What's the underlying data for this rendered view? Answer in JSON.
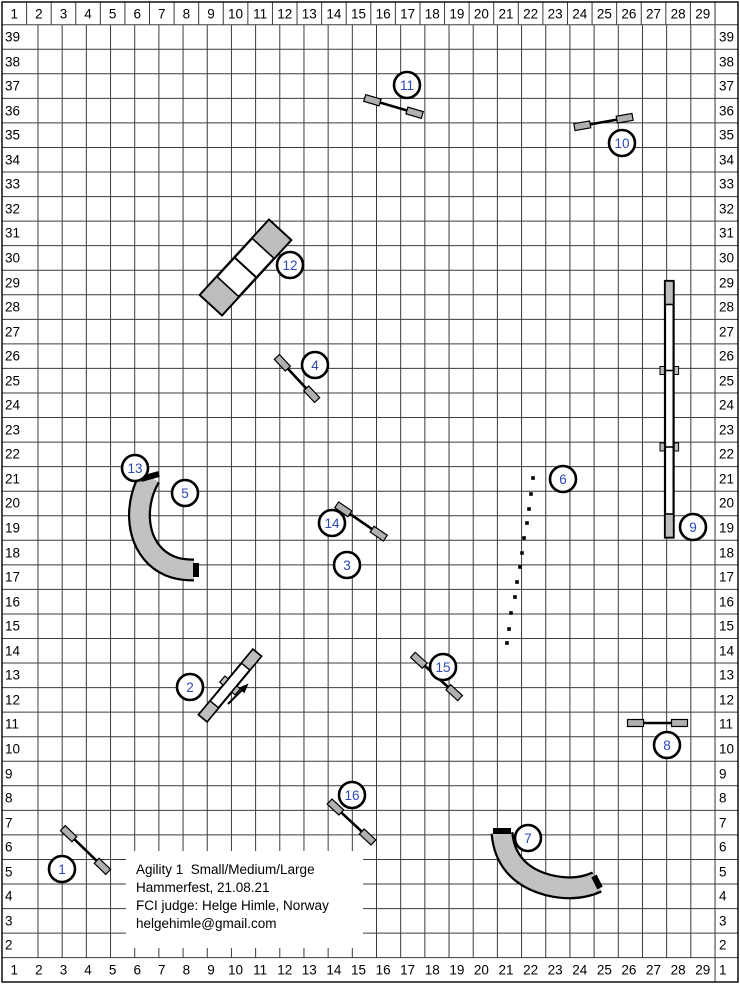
{
  "info": {
    "line1": "Agility 1  Small/Medium/Large",
    "line2": "Hammerfest, 21.08.21",
    "line3": "FCI judge: Helge Himle, Norway",
    "line4": "helgehimle@gmail.com"
  },
  "grid": {
    "col_labels": [
      "1",
      "2",
      "3",
      "4",
      "5",
      "6",
      "7",
      "8",
      "9",
      "10",
      "11",
      "12",
      "13",
      "14",
      "15",
      "16",
      "17",
      "18",
      "19",
      "20",
      "21",
      "22",
      "23",
      "24",
      "25",
      "26",
      "27",
      "28",
      "29"
    ],
    "row_labels_left": [
      "39",
      "38",
      "37",
      "36",
      "35",
      "34",
      "33",
      "32",
      "31",
      "30",
      "29",
      "28",
      "27",
      "26",
      "25",
      "24",
      "23",
      "22",
      "21",
      "20",
      "19",
      "18",
      "17",
      "16",
      "15",
      "14",
      "13",
      "12",
      "11",
      "10",
      "9",
      "8",
      "7",
      "6",
      "5",
      "4",
      "3",
      "2"
    ],
    "row_labels_right": [
      "39",
      "38",
      "37",
      "36",
      "35",
      "34",
      "33",
      "32",
      "31",
      "30",
      "29",
      "28",
      "27",
      "26",
      "25",
      "24",
      "23",
      "22",
      "21",
      "20",
      "19",
      "18",
      "17",
      "16",
      "15",
      "14",
      "13",
      "12",
      "11",
      "10",
      "9",
      "8",
      "7",
      "6",
      "5",
      "4",
      "3",
      "2",
      "1"
    ]
  },
  "colors": {
    "grid_line": "#3c3c3c",
    "border": "#000000",
    "label_text": "#000000",
    "number_text": "#2b48b4",
    "outline": "#000000",
    "tunnel_fill": "#c2c2c2",
    "wing_fill": "#b0b0b0",
    "contact_fill": "#bdbdbd",
    "white": "#ffffff"
  },
  "obstacles": {
    "numbers": [
      {
        "n": "1",
        "x": 62,
        "y": 869
      },
      {
        "n": "2",
        "x": 190,
        "y": 687
      },
      {
        "n": "3",
        "x": 347,
        "y": 565
      },
      {
        "n": "4",
        "x": 315,
        "y": 365
      },
      {
        "n": "5",
        "x": 185,
        "y": 493
      },
      {
        "n": "6",
        "x": 563,
        "y": 479
      },
      {
        "n": "7",
        "x": 528,
        "y": 838
      },
      {
        "n": "8",
        "x": 667,
        "y": 745
      },
      {
        "n": "9",
        "x": 693,
        "y": 527
      },
      {
        "n": "10",
        "x": 622,
        "y": 143
      },
      {
        "n": "11",
        "x": 407,
        "y": 85
      },
      {
        "n": "12",
        "x": 290,
        "y": 265
      },
      {
        "n": "13",
        "x": 135,
        "y": 468
      },
      {
        "n": "14",
        "x": 332,
        "y": 523
      },
      {
        "n": "15",
        "x": 443,
        "y": 667
      },
      {
        "n": "16",
        "x": 352,
        "y": 795
      }
    ],
    "jumps": [
      {
        "name": "jump-1",
        "cx": 85.5,
        "cy": 850,
        "angle": 44,
        "len": 63
      },
      {
        "name": "jump-3-14",
        "cx": 361,
        "cy": 521.5,
        "angle": 34.5,
        "len": 59
      },
      {
        "name": "jump-4",
        "cx": 297,
        "cy": 378.5,
        "angle": 47,
        "len": 59
      },
      {
        "name": "jump-8",
        "cx": 657.5,
        "cy": 723,
        "angle": 0,
        "len": 60
      },
      {
        "name": "jump-10",
        "cx": 603.5,
        "cy": 122,
        "angle": -10,
        "len": 59
      },
      {
        "name": "jump-11",
        "cx": 393.5,
        "cy": 106.5,
        "angle": 16.5,
        "len": 60
      },
      {
        "name": "jump-15",
        "cx": 436.5,
        "cy": 676.5,
        "angle": 42.5,
        "len": 64
      },
      {
        "name": "jump-16",
        "cx": 351.5,
        "cy": 822,
        "angle": 43,
        "len": 60
      }
    ],
    "wall": {
      "name": "wall-2",
      "cx": 230,
      "cy": 685.5,
      "angle": -50.3,
      "len": 85,
      "w": 11,
      "end": 18
    },
    "arrow": {
      "name": "direction-arrow",
      "x1": 228,
      "y1": 704,
      "x2": 245,
      "y2": 687
    },
    "aframe": {
      "name": "a-frame-12",
      "cx": 245.5,
      "cy": 267.5,
      "angle": -47.4,
      "len": 102,
      "w": 30,
      "end": 25
    },
    "dogwalk": {
      "name": "dog-walk-9",
      "x": 665,
      "y": 281,
      "w": 8.6,
      "h": 256.5,
      "contact": 23.5,
      "joints": [
        370.5,
        447
      ]
    },
    "tunnels": [
      {
        "name": "tunnel-5",
        "path": "M 150 477 C 136 500 134 536 156 557 C 168 568 181 570 194 570",
        "cap1": [
          141,
          479,
          159,
          474
        ],
        "cap2": [
          196,
          563,
          196,
          577
        ]
      },
      {
        "name": "tunnel-7",
        "path": "M 502 833 C 504 858 518 877 548 885 C 568 890 584 888 597 882",
        "cap1": [
          493,
          831,
          511,
          831
        ],
        "cap2": [
          594,
          876,
          600,
          888
        ]
      }
    ],
    "weave": {
      "name": "weave-poles-6",
      "dots": [
        [
          533,
          478
        ],
        [
          531,
          494
        ],
        [
          529,
          509
        ],
        [
          527,
          523
        ],
        [
          524,
          538
        ],
        [
          522,
          553
        ],
        [
          520,
          567
        ],
        [
          517,
          582
        ],
        [
          515,
          597
        ],
        [
          511,
          613
        ],
        [
          509,
          629
        ],
        [
          507,
          643
        ]
      ]
    }
  }
}
